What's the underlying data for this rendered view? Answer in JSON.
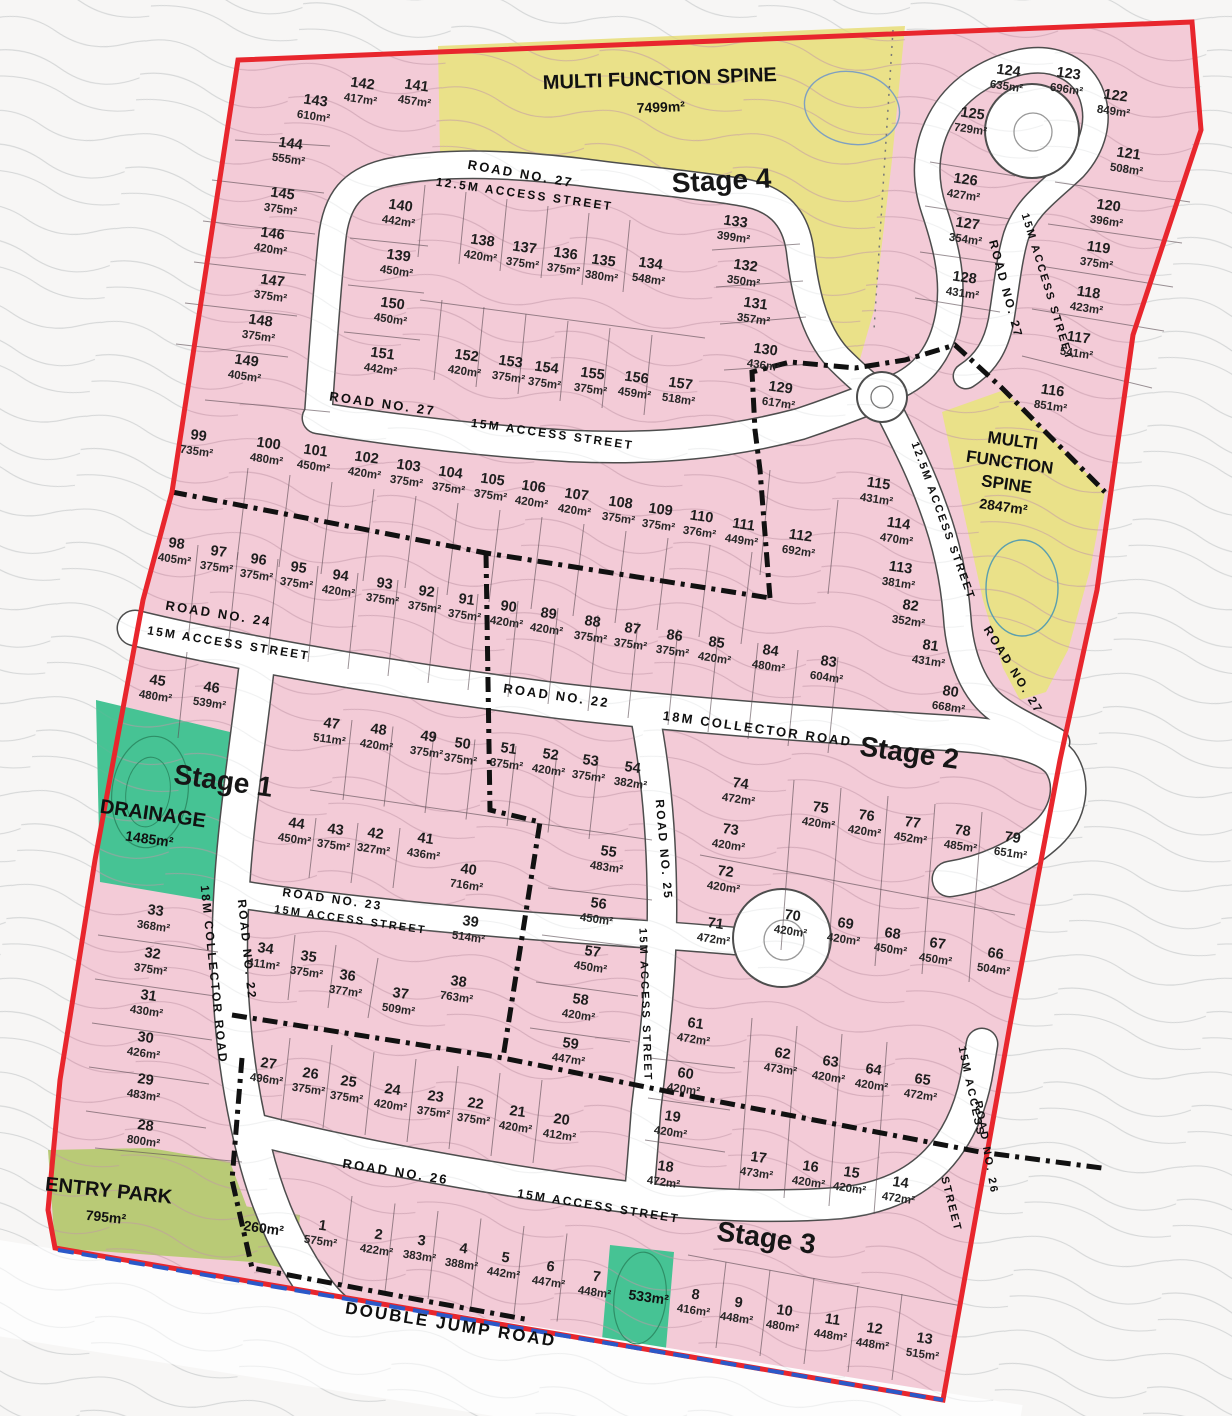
{
  "map": {
    "stages": [
      {
        "label": "Stage 1",
        "x": 222,
        "y": 790,
        "rot": 8
      },
      {
        "label": "Stage 2",
        "x": 908,
        "y": 762,
        "rot": 8
      },
      {
        "label": "Stage 3",
        "x": 765,
        "y": 1247,
        "rot": 8
      },
      {
        "label": "Stage 4",
        "x": 722,
        "y": 190,
        "rot": -3
      }
    ],
    "special_areas": [
      {
        "name": "multi-function-spine-north",
        "lines": [
          "MULTI FUNCTION SPINE"
        ],
        "area": "7499m²"
      },
      {
        "name": "multi-function-spine-east",
        "lines": [
          "MULTI",
          "FUNCTION",
          "SPINE"
        ],
        "area": "2847m²"
      },
      {
        "name": "drainage",
        "lines": [
          "DRAINAGE"
        ],
        "area": "1485m²"
      },
      {
        "name": "entry-park",
        "lines": [
          "ENTRY PARK"
        ],
        "area": "795m²"
      },
      {
        "name": "green-lot-small",
        "lines": [],
        "area": "260m²"
      },
      {
        "name": "green-lot-mid",
        "lines": [],
        "area": "533m²"
      }
    ],
    "roads": [
      {
        "text": "ROAD NO. 27",
        "x": 520,
        "y": 178,
        "rot": 10,
        "size": 13
      },
      {
        "text": "12.5M ACCESS STREET",
        "x": 524,
        "y": 198,
        "rot": 8,
        "size": 12
      },
      {
        "text": "ROAD NO. 27",
        "x": 382,
        "y": 408,
        "rot": 8,
        "size": 13
      },
      {
        "text": "15M ACCESS STREET",
        "x": 552,
        "y": 438,
        "rot": 8,
        "size": 12
      },
      {
        "text": "ROAD NO. 27",
        "x": 1002,
        "y": 290,
        "rot": 75,
        "size": 12
      },
      {
        "text": "15M ACCESS STREET",
        "x": 1044,
        "y": 288,
        "rot": 73,
        "size": 11
      },
      {
        "text": "12.5M ACCESS STREET",
        "x": 940,
        "y": 522,
        "rot": 70,
        "size": 11
      },
      {
        "text": "ROAD NO. 27",
        "x": 1010,
        "y": 672,
        "rot": 58,
        "size": 12
      },
      {
        "text": "ROAD NO. 24",
        "x": 218,
        "y": 618,
        "rot": 9,
        "size": 13
      },
      {
        "text": "15M ACCESS STREET",
        "x": 228,
        "y": 647,
        "rot": 9,
        "size": 12
      },
      {
        "text": "ROAD NO. 22",
        "x": 556,
        "y": 700,
        "rot": 8,
        "size": 13
      },
      {
        "text": "18M COLLECTOR ROAD",
        "x": 757,
        "y": 733,
        "rot": 8,
        "size": 13
      },
      {
        "text": "ROAD NO. 22",
        "x": 243,
        "y": 950,
        "rot": 84,
        "size": 12
      },
      {
        "text": "18M COLLECTOR ROAD",
        "x": 210,
        "y": 975,
        "rot": 84,
        "size": 12
      },
      {
        "text": "ROAD NO. 23",
        "x": 332,
        "y": 903,
        "rot": 8,
        "size": 12
      },
      {
        "text": "15M ACCESS STREET",
        "x": 350,
        "y": 923,
        "rot": 8,
        "size": 11
      },
      {
        "text": "ROAD NO. 25",
        "x": 660,
        "y": 850,
        "rot": 85,
        "size": 12
      },
      {
        "text": "15M ACCESS STREET",
        "x": 642,
        "y": 1005,
        "rot": 88,
        "size": 11
      },
      {
        "text": "ROAD NO. 26",
        "x": 395,
        "y": 1176,
        "rot": 9,
        "size": 13
      },
      {
        "text": "15M ACCESS STREET",
        "x": 598,
        "y": 1210,
        "rot": 9,
        "size": 12
      },
      {
        "text": "15M ACCESS",
        "x": 968,
        "y": 1092,
        "rot": 78,
        "size": 11
      },
      {
        "text": "ROAD NO. 26",
        "x": 983,
        "y": 1148,
        "rot": 80,
        "size": 11
      },
      {
        "text": "STREET",
        "x": 948,
        "y": 1205,
        "rot": 76,
        "size": 11
      },
      {
        "text": "DOUBLE JUMP ROAD",
        "x": 450,
        "y": 1330,
        "rot": 9,
        "size": 17
      }
    ],
    "lots": [
      {
        "n": "143",
        "a": "610m²",
        "x": 315,
        "y": 105
      },
      {
        "n": "142",
        "a": "417m²",
        "x": 362,
        "y": 88
      },
      {
        "n": "141",
        "a": "457m²",
        "x": 416,
        "y": 90
      },
      {
        "n": "144",
        "a": "555m²",
        "x": 290,
        "y": 148
      },
      {
        "n": "145",
        "a": "375m²",
        "x": 282,
        "y": 198
      },
      {
        "n": "146",
        "a": "420m²",
        "x": 272,
        "y": 238
      },
      {
        "n": "147",
        "a": "375m²",
        "x": 272,
        "y": 285
      },
      {
        "n": "148",
        "a": "375m²",
        "x": 260,
        "y": 325
      },
      {
        "n": "149",
        "a": "405m²",
        "x": 246,
        "y": 365
      },
      {
        "n": "140",
        "a": "442m²",
        "x": 400,
        "y": 210
      },
      {
        "n": "139",
        "a": "450m²",
        "x": 398,
        "y": 260
      },
      {
        "n": "150",
        "a": "450m²",
        "x": 392,
        "y": 308
      },
      {
        "n": "151",
        "a": "442m²",
        "x": 382,
        "y": 358
      },
      {
        "n": "138",
        "a": "420m²",
        "x": 482,
        "y": 245
      },
      {
        "n": "137",
        "a": "375m²",
        "x": 524,
        "y": 252
      },
      {
        "n": "136",
        "a": "375m²",
        "x": 565,
        "y": 258
      },
      {
        "n": "135",
        "a": "380m²",
        "x": 603,
        "y": 265
      },
      {
        "n": "134",
        "a": "548m²",
        "x": 650,
        "y": 268
      },
      {
        "n": "152",
        "a": "420m²",
        "x": 466,
        "y": 360
      },
      {
        "n": "153",
        "a": "375m²",
        "x": 510,
        "y": 366
      },
      {
        "n": "154",
        "a": "375m²",
        "x": 546,
        "y": 372
      },
      {
        "n": "155",
        "a": "375m²",
        "x": 592,
        "y": 378
      },
      {
        "n": "156",
        "a": "459m²",
        "x": 636,
        "y": 382
      },
      {
        "n": "157",
        "a": "518m²",
        "x": 680,
        "y": 388
      },
      {
        "n": "133",
        "a": "399m²",
        "x": 735,
        "y": 226
      },
      {
        "n": "132",
        "a": "350m²",
        "x": 745,
        "y": 270
      },
      {
        "n": "131",
        "a": "357m²",
        "x": 755,
        "y": 308
      },
      {
        "n": "130",
        "a": "436m²",
        "x": 765,
        "y": 354
      },
      {
        "n": "129",
        "a": "617m²",
        "x": 780,
        "y": 392
      },
      {
        "n": "124",
        "a": "635m²",
        "x": 1008,
        "y": 75
      },
      {
        "n": "123",
        "a": "696m²",
        "x": 1068,
        "y": 78
      },
      {
        "n": "122",
        "a": "849m²",
        "x": 1115,
        "y": 100
      },
      {
        "n": "125",
        "a": "729m²",
        "x": 972,
        "y": 118
      },
      {
        "n": "121",
        "a": "508m²",
        "x": 1128,
        "y": 158
      },
      {
        "n": "126",
        "a": "427m²",
        "x": 965,
        "y": 184
      },
      {
        "n": "120",
        "a": "396m²",
        "x": 1108,
        "y": 210
      },
      {
        "n": "127",
        "a": "354m²",
        "x": 967,
        "y": 228
      },
      {
        "n": "119",
        "a": "375m²",
        "x": 1098,
        "y": 252
      },
      {
        "n": "128",
        "a": "431m²",
        "x": 964,
        "y": 282
      },
      {
        "n": "118",
        "a": "423m²",
        "x": 1088,
        "y": 297
      },
      {
        "n": "117",
        "a": "541m²",
        "x": 1078,
        "y": 342
      },
      {
        "n": "116",
        "a": "851m²",
        "x": 1052,
        "y": 395
      },
      {
        "n": "99",
        "a": "735m²",
        "x": 198,
        "y": 440
      },
      {
        "n": "100",
        "a": "480m²",
        "x": 268,
        "y": 448
      },
      {
        "n": "101",
        "a": "450m²",
        "x": 315,
        "y": 455
      },
      {
        "n": "102",
        "a": "420m²",
        "x": 366,
        "y": 462
      },
      {
        "n": "103",
        "a": "375m²",
        "x": 408,
        "y": 470
      },
      {
        "n": "104",
        "a": "375m²",
        "x": 450,
        "y": 477
      },
      {
        "n": "105",
        "a": "375m²",
        "x": 492,
        "y": 484
      },
      {
        "n": "106",
        "a": "420m²",
        "x": 533,
        "y": 491
      },
      {
        "n": "107",
        "a": "420m²",
        "x": 576,
        "y": 499
      },
      {
        "n": "108",
        "a": "375m²",
        "x": 620,
        "y": 507
      },
      {
        "n": "109",
        "a": "375m²",
        "x": 660,
        "y": 514
      },
      {
        "n": "110",
        "a": "376m²",
        "x": 701,
        "y": 521
      },
      {
        "n": "111",
        "a": "449m²",
        "x": 743,
        "y": 529
      },
      {
        "n": "112",
        "a": "692m²",
        "x": 800,
        "y": 540
      },
      {
        "n": "115",
        "a": "431m²",
        "x": 878,
        "y": 488
      },
      {
        "n": "114",
        "a": "470m²",
        "x": 898,
        "y": 528
      },
      {
        "n": "113",
        "a": "381m²",
        "x": 900,
        "y": 572
      },
      {
        "n": "82",
        "a": "352m²",
        "x": 910,
        "y": 610
      },
      {
        "n": "81",
        "a": "431m²",
        "x": 930,
        "y": 650
      },
      {
        "n": "80",
        "a": "668m²",
        "x": 950,
        "y": 696
      },
      {
        "n": "98",
        "a": "405m²",
        "x": 176,
        "y": 548
      },
      {
        "n": "97",
        "a": "375m²",
        "x": 218,
        "y": 556
      },
      {
        "n": "96",
        "a": "375m²",
        "x": 258,
        "y": 564
      },
      {
        "n": "95",
        "a": "375m²",
        "x": 298,
        "y": 572
      },
      {
        "n": "94",
        "a": "420m²",
        "x": 340,
        "y": 580
      },
      {
        "n": "93",
        "a": "375m²",
        "x": 384,
        "y": 588
      },
      {
        "n": "92",
        "a": "375m²",
        "x": 426,
        "y": 596
      },
      {
        "n": "91",
        "a": "375m²",
        "x": 466,
        "y": 604
      },
      {
        "n": "90",
        "a": "420m²",
        "x": 508,
        "y": 611
      },
      {
        "n": "89",
        "a": "420m²",
        "x": 548,
        "y": 618
      },
      {
        "n": "88",
        "a": "375m²",
        "x": 592,
        "y": 626
      },
      {
        "n": "87",
        "a": "375m²",
        "x": 632,
        "y": 633
      },
      {
        "n": "86",
        "a": "375m²",
        "x": 674,
        "y": 640
      },
      {
        "n": "85",
        "a": "420m²",
        "x": 716,
        "y": 647
      },
      {
        "n": "84",
        "a": "480m²",
        "x": 770,
        "y": 655
      },
      {
        "n": "83",
        "a": "604m²",
        "x": 828,
        "y": 666
      },
      {
        "n": "45",
        "a": "480m²",
        "x": 157,
        "y": 685
      },
      {
        "n": "46",
        "a": "539m²",
        "x": 211,
        "y": 692
      },
      {
        "n": "47",
        "a": "511m²",
        "x": 331,
        "y": 728
      },
      {
        "n": "48",
        "a": "420m²",
        "x": 378,
        "y": 734
      },
      {
        "n": "49",
        "a": "375m²",
        "x": 428,
        "y": 741
      },
      {
        "n": "50",
        "a": "375m²",
        "x": 462,
        "y": 748
      },
      {
        "n": "51",
        "a": "375m²",
        "x": 508,
        "y": 753
      },
      {
        "n": "52",
        "a": "420m²",
        "x": 550,
        "y": 759
      },
      {
        "n": "53",
        "a": "375m²",
        "x": 590,
        "y": 765
      },
      {
        "n": "54",
        "a": "382m²",
        "x": 632,
        "y": 772
      },
      {
        "n": "74",
        "a": "472m²",
        "x": 740,
        "y": 788
      },
      {
        "n": "75",
        "a": "420m²",
        "x": 820,
        "y": 812
      },
      {
        "n": "76",
        "a": "420m²",
        "x": 866,
        "y": 820
      },
      {
        "n": "77",
        "a": "452m²",
        "x": 912,
        "y": 827
      },
      {
        "n": "78",
        "a": "485m²",
        "x": 962,
        "y": 835
      },
      {
        "n": "79",
        "a": "651m²",
        "x": 1012,
        "y": 842
      },
      {
        "n": "73",
        "a": "420m²",
        "x": 730,
        "y": 834
      },
      {
        "n": "72",
        "a": "420m²",
        "x": 725,
        "y": 876
      },
      {
        "n": "71",
        "a": "472m²",
        "x": 715,
        "y": 928
      },
      {
        "n": "70",
        "a": "420m²",
        "x": 792,
        "y": 920
      },
      {
        "n": "69",
        "a": "420m²",
        "x": 845,
        "y": 928
      },
      {
        "n": "68",
        "a": "450m²",
        "x": 892,
        "y": 938
      },
      {
        "n": "67",
        "a": "450m²",
        "x": 937,
        "y": 948
      },
      {
        "n": "66",
        "a": "504m²",
        "x": 995,
        "y": 958
      },
      {
        "n": "33",
        "a": "368m²",
        "x": 155,
        "y": 915
      },
      {
        "n": "32",
        "a": "375m²",
        "x": 152,
        "y": 958
      },
      {
        "n": "31",
        "a": "430m²",
        "x": 148,
        "y": 1000
      },
      {
        "n": "30",
        "a": "426m²",
        "x": 145,
        "y": 1042
      },
      {
        "n": "29",
        "a": "483m²",
        "x": 145,
        "y": 1084
      },
      {
        "n": "28",
        "a": "800m²",
        "x": 145,
        "y": 1130
      },
      {
        "n": "44",
        "a": "450m²",
        "x": 296,
        "y": 828
      },
      {
        "n": "43",
        "a": "375m²",
        "x": 335,
        "y": 834
      },
      {
        "n": "42",
        "a": "327m²",
        "x": 375,
        "y": 838
      },
      {
        "n": "41",
        "a": "436m²",
        "x": 425,
        "y": 843
      },
      {
        "n": "40",
        "a": "716m²",
        "x": 468,
        "y": 874
      },
      {
        "n": "39",
        "a": "514m²",
        "x": 470,
        "y": 926
      },
      {
        "n": "38",
        "a": "763m²",
        "x": 458,
        "y": 986
      },
      {
        "n": "34",
        "a": "411m²",
        "x": 265,
        "y": 953
      },
      {
        "n": "35",
        "a": "375m²",
        "x": 308,
        "y": 961
      },
      {
        "n": "36",
        "a": "377m²",
        "x": 347,
        "y": 980
      },
      {
        "n": "37",
        "a": "509m²",
        "x": 400,
        "y": 998
      },
      {
        "n": "55",
        "a": "483m²",
        "x": 608,
        "y": 856
      },
      {
        "n": "56",
        "a": "450m²",
        "x": 598,
        "y": 908
      },
      {
        "n": "57",
        "a": "450m²",
        "x": 592,
        "y": 956
      },
      {
        "n": "58",
        "a": "420m²",
        "x": 580,
        "y": 1004
      },
      {
        "n": "59",
        "a": "447m²",
        "x": 570,
        "y": 1048
      },
      {
        "n": "27",
        "a": "496m²",
        "x": 268,
        "y": 1068
      },
      {
        "n": "26",
        "a": "375m²",
        "x": 310,
        "y": 1078
      },
      {
        "n": "25",
        "a": "375m²",
        "x": 348,
        "y": 1086
      },
      {
        "n": "24",
        "a": "420m²",
        "x": 392,
        "y": 1094
      },
      {
        "n": "23",
        "a": "375m²",
        "x": 435,
        "y": 1101
      },
      {
        "n": "22",
        "a": "375m²",
        "x": 475,
        "y": 1108
      },
      {
        "n": "21",
        "a": "420m²",
        "x": 517,
        "y": 1116
      },
      {
        "n": "20",
        "a": "412m²",
        "x": 561,
        "y": 1124
      },
      {
        "n": "61",
        "a": "472m²",
        "x": 695,
        "y": 1028
      },
      {
        "n": "62",
        "a": "473m²",
        "x": 782,
        "y": 1058
      },
      {
        "n": "63",
        "a": "420m²",
        "x": 830,
        "y": 1066
      },
      {
        "n": "64",
        "a": "420m²",
        "x": 873,
        "y": 1074
      },
      {
        "n": "65",
        "a": "472m²",
        "x": 922,
        "y": 1084
      },
      {
        "n": "60",
        "a": "420m²",
        "x": 685,
        "y": 1078
      },
      {
        "n": "19",
        "a": "420m²",
        "x": 672,
        "y": 1121
      },
      {
        "n": "18",
        "a": "472m²",
        "x": 665,
        "y": 1171
      },
      {
        "n": "17",
        "a": "473m²",
        "x": 758,
        "y": 1162
      },
      {
        "n": "16",
        "a": "420m²",
        "x": 810,
        "y": 1171
      },
      {
        "n": "15",
        "a": "420m²",
        "x": 851,
        "y": 1177
      },
      {
        "n": "14",
        "a": "472m²",
        "x": 900,
        "y": 1187
      },
      {
        "n": "1",
        "a": "575m²",
        "x": 322,
        "y": 1230
      },
      {
        "n": "2",
        "a": "422m²",
        "x": 378,
        "y": 1239
      },
      {
        "n": "3",
        "a": "383m²",
        "x": 421,
        "y": 1245
      },
      {
        "n": "4",
        "a": "388m²",
        "x": 463,
        "y": 1253
      },
      {
        "n": "5",
        "a": "442m²",
        "x": 505,
        "y": 1262
      },
      {
        "n": "6",
        "a": "447m²",
        "x": 550,
        "y": 1271
      },
      {
        "n": "7",
        "a": "448m²",
        "x": 596,
        "y": 1281
      },
      {
        "n": "8",
        "a": "416m²",
        "x": 695,
        "y": 1299
      },
      {
        "n": "9",
        "a": "448m²",
        "x": 738,
        "y": 1307
      },
      {
        "n": "10",
        "a": "480m²",
        "x": 784,
        "y": 1315
      },
      {
        "n": "11",
        "a": "448m²",
        "x": 832,
        "y": 1324
      },
      {
        "n": "12",
        "a": "448m²",
        "x": 874,
        "y": 1333
      },
      {
        "n": "13",
        "a": "515m²",
        "x": 924,
        "y": 1343
      }
    ],
    "colors": {
      "boundary": "#e8262d",
      "lot_fill": "#f3cbd7",
      "spine_fill": "#eae189",
      "drainage_fill": "#46c394",
      "park_fill": "#b9ca76",
      "road_fill": "#ffffff",
      "stage_line": "#111111",
      "frontage_line": "#2b58c8"
    }
  }
}
